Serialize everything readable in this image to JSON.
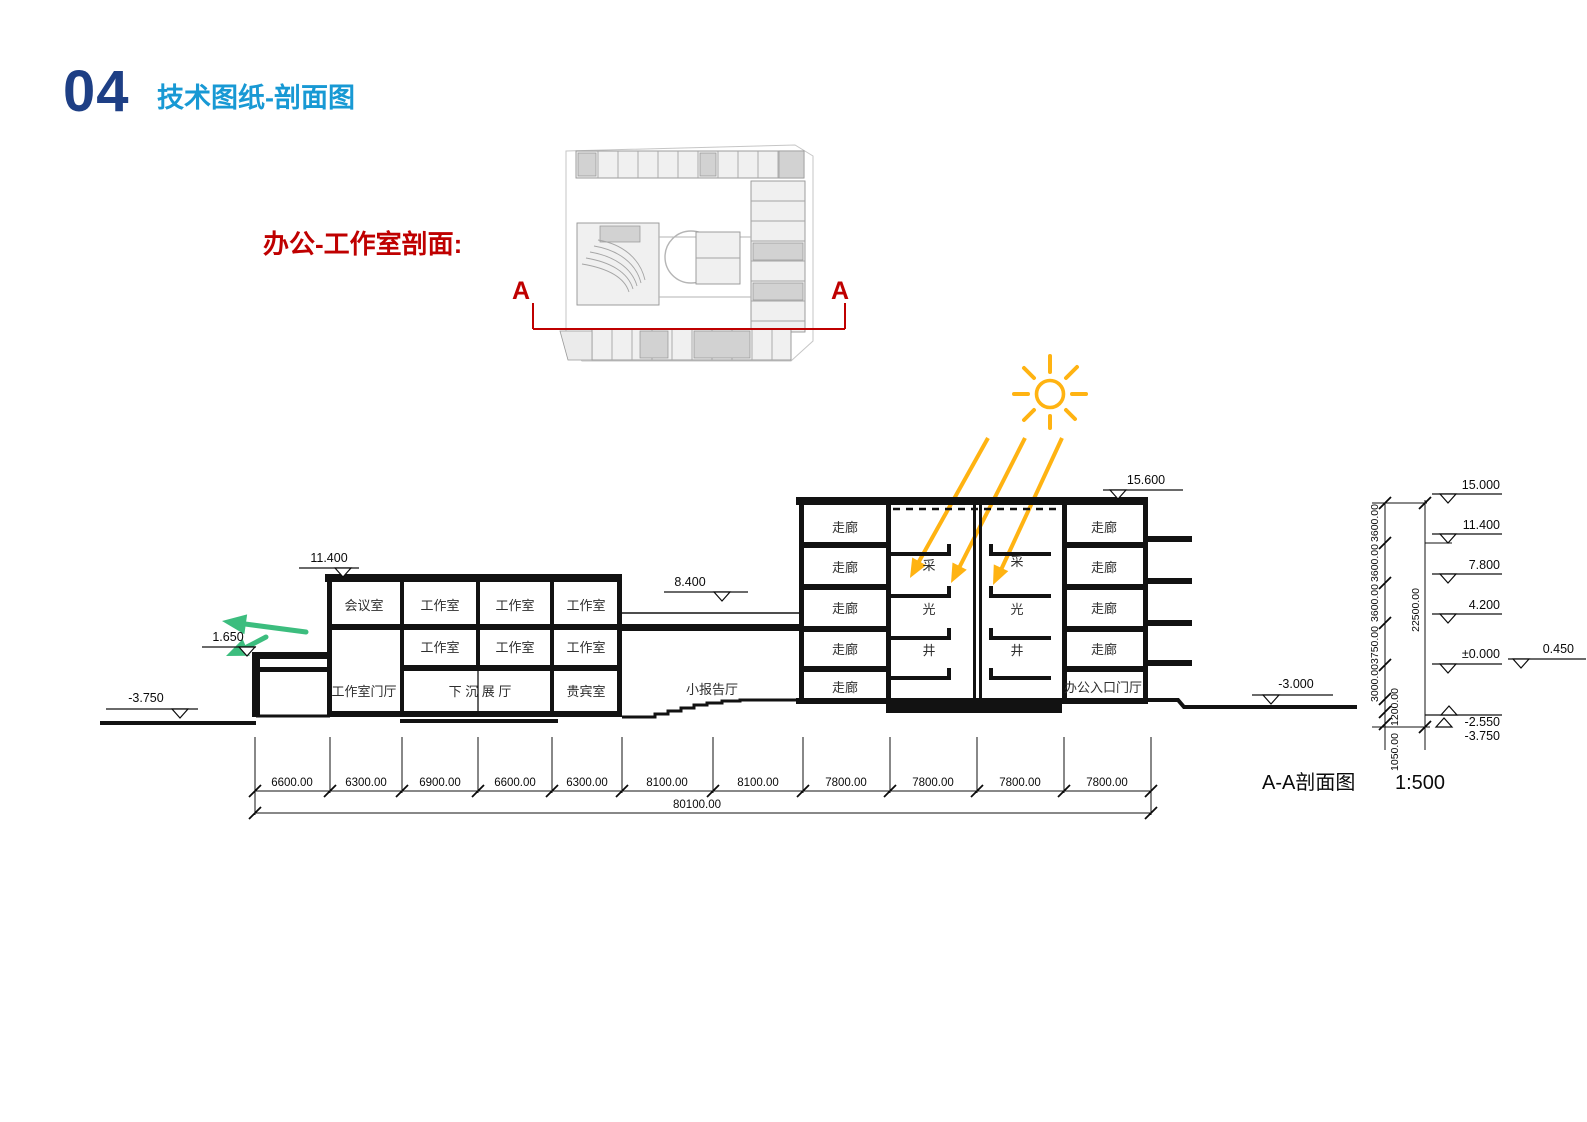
{
  "header": {
    "number": "04",
    "title": "技术图纸-剖面图"
  },
  "plan_callout": {
    "label": "办公-工作室剖面:",
    "marker": "A"
  },
  "section": {
    "levels": {
      "l15600": "15.600",
      "l11400": "11.400",
      "l8400": "8.400",
      "l1650": "1.650",
      "lm3750": "-3.750",
      "lm3000": "-3.000"
    },
    "rooms": {
      "meeting": "会议室",
      "studio": "工作室",
      "studio_lobby": "工作室门厅",
      "sunken_hall": "下 沉 展 厅",
      "vip": "贵宾室",
      "small_lecture": "小报告厅",
      "corridor": "走廊",
      "office_lobby": "办公入口门厅",
      "well_cai": "采",
      "well_guang": "光",
      "well_jing": "井"
    },
    "right_ladder": {
      "levels": [
        "15.000",
        "11.400",
        "7.800",
        "4.200",
        "±0.000",
        "0.450",
        "-2.550",
        "-3.750"
      ],
      "chain": [
        "3600.00",
        "3600.00",
        "3600.00",
        "3750.00",
        "3000.00",
        "1200.00",
        "1050.00"
      ],
      "total": "22500.00"
    },
    "dims": {
      "bays": [
        "6600.00",
        "6300.00",
        "6900.00",
        "6600.00",
        "6300.00",
        "8100.00",
        "8100.00",
        "7800.00",
        "7800.00",
        "7800.00",
        "7800.00"
      ],
      "total": "80100.00"
    },
    "caption": {
      "title": "A-A剖面图",
      "scale": "1:500"
    }
  },
  "colors": {
    "navy": "#1e3f85",
    "accent_blue": "#1899d4",
    "red": "#bf0000",
    "sun_yellow": "#ffb312",
    "green": "#3cbd7e",
    "ink": "#121212"
  }
}
